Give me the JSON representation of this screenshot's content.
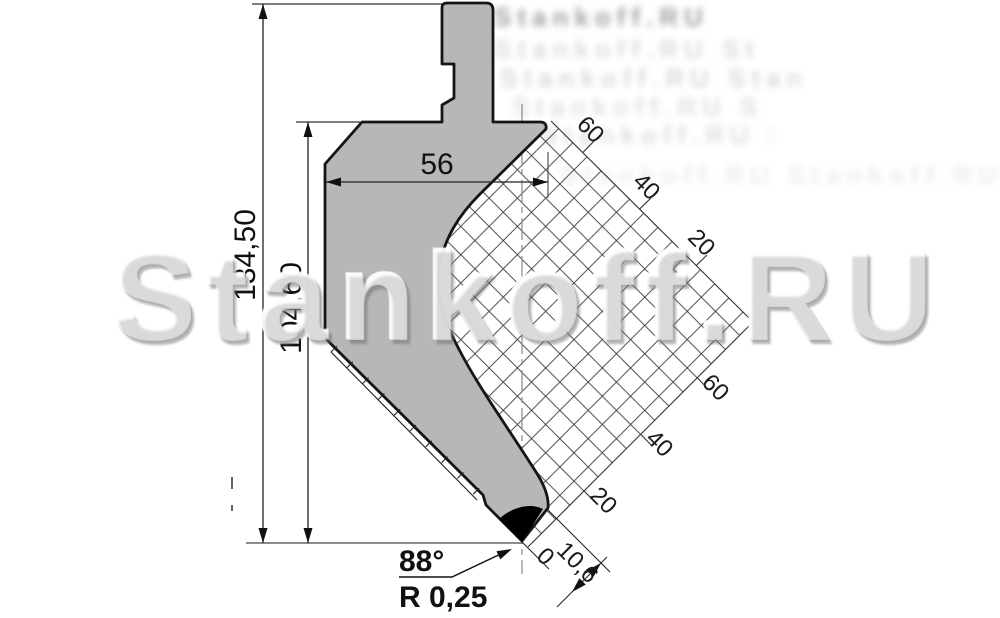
{
  "drawing": {
    "type": "press-brake punch technical drawing",
    "dims": {
      "total_height": "134,50",
      "working_height": "104,60",
      "body_width": "56",
      "tip_angle": "88°",
      "tip_radius": "R 0,25",
      "nose_offset": "10,6"
    },
    "grid": {
      "top_labels": [
        "60",
        "40",
        "20",
        "0"
      ],
      "bottom_labels": [
        "60",
        "40",
        "20"
      ],
      "zero_label": "0"
    },
    "colors": {
      "body_fill": "#b7b7b7",
      "outline": "#151515",
      "grid_line": "#3a3a3a",
      "dim_line": "#222222",
      "watermark_gray": "#c9c9c9"
    }
  },
  "watermark": {
    "text": "Stankoff.RU",
    "tile_text": "Stankoff.RU Stankoff.RU Stankoff.RU Stankoff.RU"
  }
}
